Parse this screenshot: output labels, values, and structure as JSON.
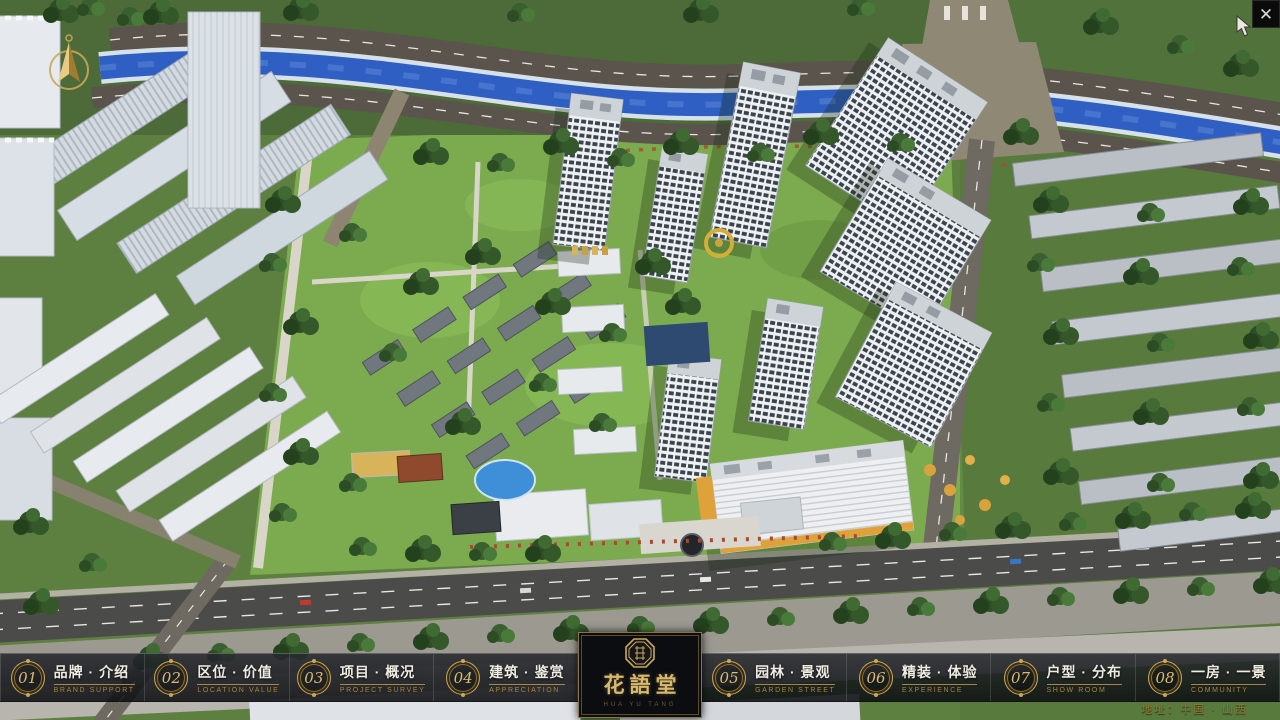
{
  "window": {
    "close_glyph": "✕"
  },
  "logo": {
    "name": "花語堂",
    "subtext": "HUA YU TANG",
    "seal_icon": "octagonal-seal"
  },
  "nav": {
    "items": [
      {
        "num": "01",
        "label": "品牌 · 介绍",
        "sub": "BRAND SUPPORT"
      },
      {
        "num": "02",
        "label": "区位 · 价值",
        "sub": "LOCATION VALUE"
      },
      {
        "num": "03",
        "label": "项目 · 概况",
        "sub": "PROJECT SURVEY"
      },
      {
        "num": "04",
        "label": "建筑 · 鉴赏",
        "sub": "APPRECIATION"
      },
      {
        "num": "05",
        "label": "园林 · 景观",
        "sub": "GARDEN STREET"
      },
      {
        "num": "06",
        "label": "精装 · 体验",
        "sub": "EXPERIENCE"
      },
      {
        "num": "07",
        "label": "户型 · 分布",
        "sub": "SHOW ROOM"
      },
      {
        "num": "08",
        "label": "一房 · 一景",
        "sub": "COMMUNITY"
      }
    ]
  },
  "footer": {
    "address": "地址：中国 · 山西"
  },
  "icons": {
    "compass": "north-compass",
    "cursor": "mouse-pointer"
  },
  "colors": {
    "gold": "#c9a85c",
    "bar_bg": "#15181c",
    "river_blue": "#2f5fc2",
    "highlight_orange": "#dfa23b"
  }
}
